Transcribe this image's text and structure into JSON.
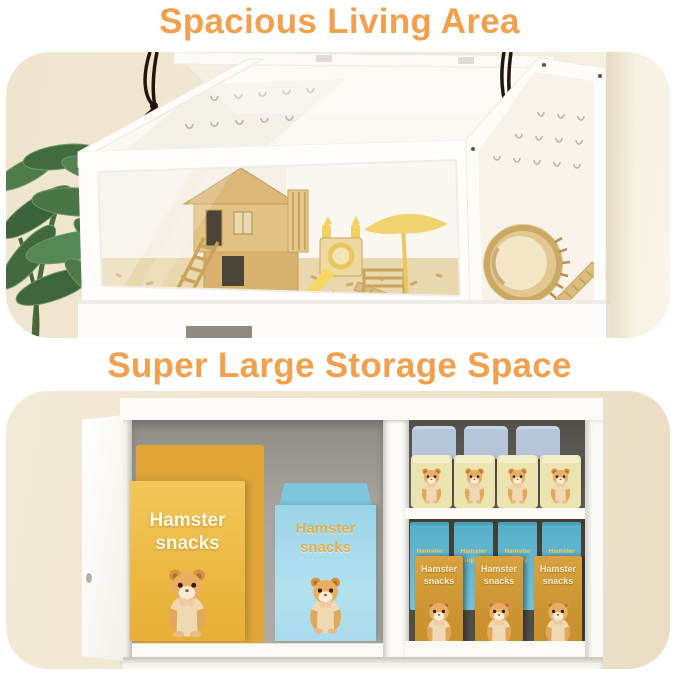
{
  "page": {
    "width": 679,
    "height": 676,
    "background": "#FFFFFF"
  },
  "sections": [
    {
      "id": "living-area",
      "title": "Spacious Living Area"
    },
    {
      "id": "storage-space",
      "title": "Super Large Storage Space"
    }
  ],
  "storage": {
    "bag_yellow": {
      "line1": "Hamster",
      "line2": "snacks"
    },
    "bag_blue": {
      "line1": "Hamster",
      "line2": "snacks"
    },
    "box_orange": {
      "line1": "Hamster",
      "line2": "snacks",
      "count": 3
    },
    "box_teal": {
      "line1": "Hamster",
      "line2": "supply",
      "count": 4
    },
    "canister_cream_count": 4,
    "canister_blue_count": 3
  },
  "colors": {
    "title_orange": "#F2A04E",
    "wall_beige": "#EFE5CF",
    "cage_white": "#FDFCFA",
    "wood": "#D9B878",
    "toy_yellow": "#F2D064",
    "plant_green": "#4A7747",
    "cord_black": "#23150B",
    "bag_yellow_front": "#ECB943",
    "bag_yellow_back": "#DFA637",
    "bag_blue": "#ABDCEB",
    "bag_blue_label": "#E2B04A",
    "box_teal": "#5FB4CC",
    "box_teal_label": "#EFC85A",
    "box_orange": "#CC9430",
    "canister_cream": "#ECE4B0",
    "canister_blue": "#B5C5DA"
  }
}
